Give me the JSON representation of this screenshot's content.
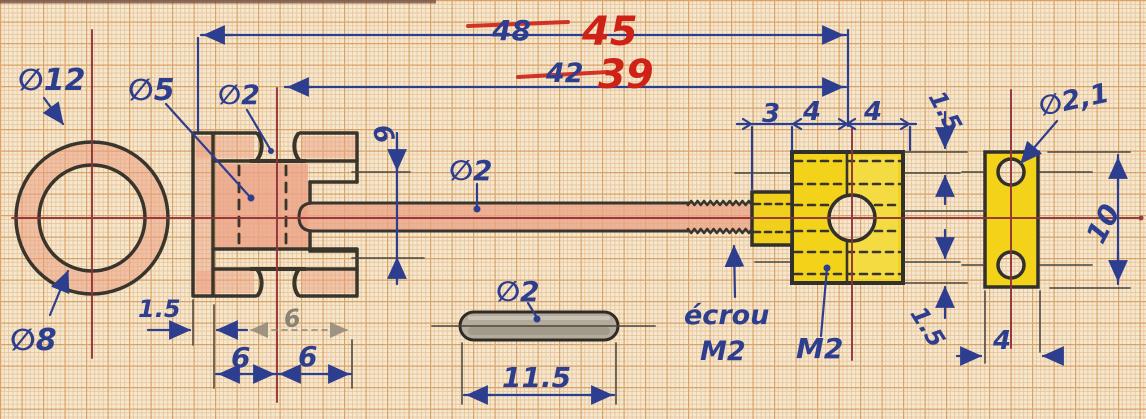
{
  "drawing": {
    "type": "hand-drawn mechanical drawing on millimeter graph paper",
    "colors": {
      "paper": "#f4e8cf",
      "grid_minor": "#e7b98c",
      "grid_major": "#d3924f",
      "ink_blue": "#2e3e8e",
      "correction_red": "#cf2217",
      "pencil_outline": "#3a352c",
      "centerline_red": "#8e3038",
      "brass_shade": "#eba184",
      "part_yellow": "#f2d319",
      "pin_gray": "#b3ab9c"
    },
    "overall_dims": {
      "top_old": "48",
      "top_new": "45",
      "second_old": "42",
      "second_new": "39"
    },
    "ring_view": {
      "outer_diameter": "∅12",
      "inner_diameter": "∅8"
    },
    "body_view": {
      "bore_diameter": "∅5",
      "groove_diameter": "∅2",
      "wall_thickness": "1.5",
      "width_left": "6",
      "width_right": "6",
      "width_erased": "6",
      "bore_depth": "6"
    },
    "shaft": {
      "diameter": "∅2"
    },
    "pin_view": {
      "diameter": "∅2",
      "length": "11.5"
    },
    "block_view": {
      "seg1": "3",
      "seg2": "4",
      "seg3": "4",
      "offset_top": "1.5",
      "offset_bottom": "1.5",
      "nut_note_word": "écrou",
      "nut_note_size": "M2",
      "thread_label": "M2"
    },
    "plate_view": {
      "hole_diameter": "∅2,1",
      "height": "10",
      "width": "4"
    }
  }
}
